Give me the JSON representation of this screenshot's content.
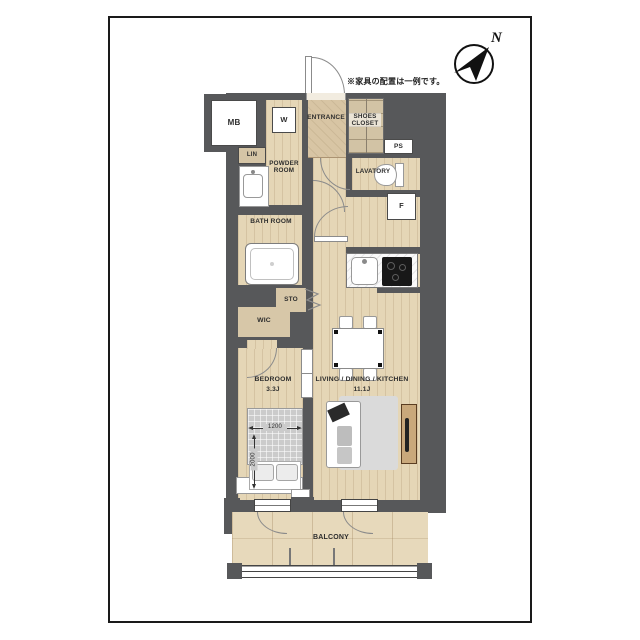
{
  "note": "※家具の配置は一例です。",
  "compass": {
    "north": "N"
  },
  "rooms": {
    "mb": "MB",
    "washer": "W",
    "entrance": "ENTRANCE",
    "shoes_closet": "SHOES CLOSET",
    "ps": "PS",
    "lin": "LIN",
    "powder_room": "POWDER ROOM",
    "lavatory": "LAVATORY",
    "bath_room": "BATH ROOM",
    "fridge": "F",
    "storage": "STO",
    "wic": "WIC",
    "bedroom": "BEDROOM",
    "bedroom_size": "3.3J",
    "ldk": "LIVING / DINING / KITCHEN",
    "ldk_size": "11.1J",
    "balcony": "BALCONY"
  },
  "bed_dimensions": {
    "width": "1200",
    "depth": "2000"
  },
  "colors": {
    "wall": "#57585a",
    "wood_floor": "#e5d6b6",
    "balcony_floor": "#e7d9bb",
    "fixture": "#ffffff",
    "bed": "#cbcbcb",
    "tv_board": "#c9a87b"
  }
}
